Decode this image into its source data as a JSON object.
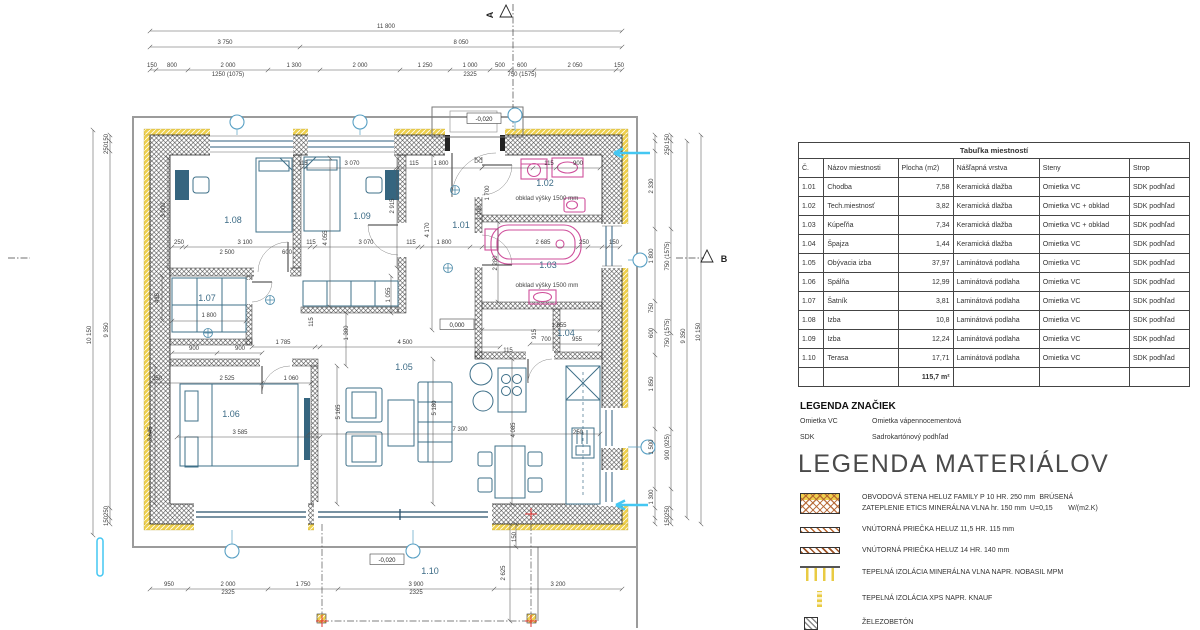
{
  "room_table": {
    "title": "Tabuľka miestností",
    "headers": [
      "Č.",
      "Názov miestnosti",
      "Plocha (m2)",
      "Nášľapná vrstva",
      "Steny",
      "Strop"
    ],
    "rows": [
      [
        "1.01",
        "Chodba",
        "7,58",
        "Keramická dlažba",
        "Omietka VC",
        "SDK podhľad"
      ],
      [
        "1.02",
        "Tech.miestnosť",
        "3,82",
        "Keramická dlažba",
        "Omietka VC + obklad",
        "SDK podhľad"
      ],
      [
        "1.03",
        "Kúpeľňa",
        "7,34",
        "Keramická dlažba",
        "Omietka VC + obklad",
        "SDK podhľad"
      ],
      [
        "1.04",
        "Špajza",
        "1,44",
        "Keramická dlažba",
        "Omietka VC",
        "SDK podhľad"
      ],
      [
        "1.05",
        "Obývacia izba",
        "37,97",
        "Laminátová podlaha",
        "Omietka VC",
        "SDK podhľad"
      ],
      [
        "1.06",
        "Spálňa",
        "12,99",
        "Laminátová podlaha",
        "Omietka VC",
        "SDK podhľad"
      ],
      [
        "1.07",
        "Šatník",
        "3,81",
        "Laminátová podlaha",
        "Omietka VC",
        "SDK podhľad"
      ],
      [
        "1.08",
        "Izba",
        "10,8",
        "Laminátová podlaha",
        "Omietka VC",
        "SDK podhľad"
      ],
      [
        "1.09",
        "Izba",
        "12,24",
        "Laminátová podlaha",
        "Omietka VC",
        "SDK podhľad"
      ],
      [
        "1.10",
        "Terasa",
        "17,71",
        "Laminátová podlaha",
        "Omietka VC",
        "SDK podhľad"
      ]
    ],
    "total": "115,7 m²"
  },
  "legend_symbols": {
    "title": "LEGENDA ZNAČIEK",
    "items": [
      {
        "abbr": "Omietka VC",
        "desc": "Omietka vápennocementová"
      },
      {
        "abbr": "SDK",
        "desc": "Sadrokartónový podhľad"
      }
    ]
  },
  "legend_materials": {
    "title": "LEGENDA MATERIÁLOV",
    "items": [
      {
        "icon": "extwall",
        "text": "OBVODOVÁ STENA HELUZ FAMILY P 10 HR. 250 mm  BRÚSENÁ\nZATEPLENIE ETICS MINERÁLNA VLNA hr. 150 mm  U=0,15        W/(m2.K)"
      },
      {
        "icon": "p115",
        "text": "VNÚTORNÁ PRIEČKA HELUZ 11,5 HR. 115 mm"
      },
      {
        "icon": "p140",
        "text": "VNÚTORNÁ PRIEČKA HELUZ 14 HR. 140 mm"
      },
      {
        "icon": "wool",
        "text": "TEPELNÁ IZOLÁCIA MINERÁLNA VLNA NAPR. NOBASIL MPM"
      },
      {
        "icon": "xps",
        "text": "TEPELNÁ IZOLÁCIA XPS NAPR. KNAUF"
      },
      {
        "icon": "zb",
        "text": "ŽELEZOBETÓN"
      }
    ]
  },
  "plan": {
    "rooms": [
      {
        "t": "1.01",
        "x": 461,
        "y": 228
      },
      {
        "t": "1.02",
        "x": 545,
        "y": 186
      },
      {
        "t": "1.03",
        "x": 548,
        "y": 268
      },
      {
        "t": "1.04",
        "x": 566,
        "y": 336
      },
      {
        "t": "1.05",
        "x": 404,
        "y": 370
      },
      {
        "t": "1.06",
        "x": 231,
        "y": 417
      },
      {
        "t": "1.07",
        "x": 207,
        "y": 301
      },
      {
        "t": "1.08",
        "x": 233,
        "y": 223
      },
      {
        "t": "1.09",
        "x": 362,
        "y": 219
      },
      {
        "t": "1.10",
        "x": 430,
        "y": 574
      }
    ],
    "notes": [
      {
        "t": "obklad výšky 1500 mm",
        "x": 547,
        "y": 200
      },
      {
        "t": "obklad výšky 1500 mm",
        "x": 547,
        "y": 287
      }
    ],
    "levels": [
      {
        "t": "-0,020",
        "x": 484,
        "y": 121
      },
      {
        "t": "0,000",
        "x": 457,
        "y": 327
      },
      {
        "t": "-0,020",
        "x": 387,
        "y": 562
      }
    ],
    "sections": [
      {
        "t": "A",
        "x": 493,
        "y": 15,
        "r": -90
      },
      {
        "t": "B",
        "x": 724,
        "y": 262
      }
    ],
    "dims": [
      {
        "t": "11 800",
        "x": 386,
        "y": 28
      },
      {
        "t": "3 750",
        "x": 225,
        "y": 44
      },
      {
        "t": "8 050",
        "x": 461,
        "y": 44
      },
      {
        "t": "150",
        "x": 152,
        "y": 67
      },
      {
        "t": "800",
        "x": 172,
        "y": 67
      },
      {
        "t": "2 000",
        "x": 228,
        "y": 67
      },
      {
        "t": "1 300",
        "x": 294,
        "y": 67
      },
      {
        "t": "2 000",
        "x": 360,
        "y": 67
      },
      {
        "t": "1 250",
        "x": 425,
        "y": 67
      },
      {
        "t": "1 000",
        "x": 470,
        "y": 67
      },
      {
        "t": "500",
        "x": 500,
        "y": 67
      },
      {
        "t": "600",
        "x": 522,
        "y": 67
      },
      {
        "t": "2 050",
        "x": 575,
        "y": 67
      },
      {
        "t": "150",
        "x": 619,
        "y": 67
      },
      {
        "t": "1250 (1075)",
        "x": 228,
        "y": 76
      },
      {
        "t": "2325",
        "x": 470,
        "y": 76
      },
      {
        "t": "750 (1575)",
        "x": 522,
        "y": 76
      },
      {
        "t": "950",
        "x": 169,
        "y": 586
      },
      {
        "t": "2 000",
        "x": 228,
        "y": 586
      },
      {
        "t": "2325",
        "x": 228,
        "y": 594
      },
      {
        "t": "1 750",
        "x": 303,
        "y": 586
      },
      {
        "t": "3 900",
        "x": 416,
        "y": 586
      },
      {
        "t": "2325",
        "x": 416,
        "y": 594
      },
      {
        "t": "3 200",
        "x": 558,
        "y": 586
      },
      {
        "t": "2 625",
        "x": 505,
        "y": 573,
        "r": -90
      },
      {
        "t": "150",
        "x": 516,
        "y": 537,
        "r": -90
      },
      {
        "t": "150",
        "x": 108,
        "y": 139,
        "r": -90
      },
      {
        "t": "250",
        "x": 108,
        "y": 149,
        "r": -90
      },
      {
        "t": "9 350",
        "x": 108,
        "y": 330,
        "r": -90
      },
      {
        "t": "250",
        "x": 108,
        "y": 511,
        "r": -90
      },
      {
        "t": "150",
        "x": 108,
        "y": 521,
        "r": -90
      },
      {
        "t": "10 150",
        "x": 91,
        "y": 335,
        "r": -90
      },
      {
        "t": "2 330",
        "x": 653,
        "y": 186,
        "r": -90
      },
      {
        "t": "1 800",
        "x": 653,
        "y": 256,
        "r": -90
      },
      {
        "t": "750",
        "x": 653,
        "y": 308,
        "r": -90
      },
      {
        "t": "600",
        "x": 653,
        "y": 333,
        "r": -90
      },
      {
        "t": "1 850",
        "x": 653,
        "y": 384,
        "r": -90
      },
      {
        "t": "1 500",
        "x": 653,
        "y": 447,
        "r": -90
      },
      {
        "t": "1 300",
        "x": 653,
        "y": 497,
        "r": -90
      },
      {
        "t": "150",
        "x": 669,
        "y": 139,
        "r": -90
      },
      {
        "t": "250",
        "x": 669,
        "y": 150,
        "r": -90
      },
      {
        "t": "750 (1575)",
        "x": 669,
        "y": 256,
        "r": -90
      },
      {
        "t": "750 (1575)",
        "x": 669,
        "y": 333,
        "r": -90
      },
      {
        "t": "900 (925)",
        "x": 669,
        "y": 447,
        "r": -90
      },
      {
        "t": "250",
        "x": 669,
        "y": 511,
        "r": -90
      },
      {
        "t": "150",
        "x": 669,
        "y": 521,
        "r": -90
      },
      {
        "t": "9 350",
        "x": 685,
        "y": 336,
        "r": -90
      },
      {
        "t": "10 150",
        "x": 700,
        "y": 332,
        "r": -90
      },
      {
        "t": "3 000",
        "x": 165,
        "y": 210,
        "r": -90
      },
      {
        "t": "250",
        "x": 179,
        "y": 244
      },
      {
        "t": "3 100",
        "x": 245,
        "y": 244
      },
      {
        "t": "2 500",
        "x": 227,
        "y": 254
      },
      {
        "t": "600",
        "x": 287,
        "y": 254
      },
      {
        "t": "115",
        "x": 311,
        "y": 244
      },
      {
        "t": "3 070",
        "x": 366,
        "y": 244
      },
      {
        "t": "115",
        "x": 303,
        "y": 165
      },
      {
        "t": "3 070",
        "x": 352,
        "y": 165
      },
      {
        "t": "4 055",
        "x": 327,
        "y": 238,
        "r": -90
      },
      {
        "t": "2 915",
        "x": 394,
        "y": 206,
        "r": -90
      },
      {
        "t": "4 170",
        "x": 429,
        "y": 230,
        "r": -90
      },
      {
        "t": "115",
        "x": 411,
        "y": 244
      },
      {
        "t": "1 800",
        "x": 444,
        "y": 244
      },
      {
        "t": "115",
        "x": 414,
        "y": 165
      },
      {
        "t": "1 800",
        "x": 441,
        "y": 165
      },
      {
        "t": "115",
        "x": 549,
        "y": 165
      },
      {
        "t": "900",
        "x": 578,
        "y": 165
      },
      {
        "t": "1 700",
        "x": 489,
        "y": 193,
        "r": -90
      },
      {
        "t": "1 100",
        "x": 481,
        "y": 213,
        "r": -90
      },
      {
        "t": "2 685",
        "x": 543,
        "y": 244
      },
      {
        "t": "250",
        "x": 584,
        "y": 244
      },
      {
        "t": "150",
        "x": 614,
        "y": 244
      },
      {
        "t": "2 280",
        "x": 497,
        "y": 263,
        "r": -90
      },
      {
        "t": "1 655",
        "x": 559,
        "y": 327
      },
      {
        "t": "700",
        "x": 546,
        "y": 341
      },
      {
        "t": "955",
        "x": 577,
        "y": 341
      },
      {
        "t": "915",
        "x": 536,
        "y": 334,
        "r": -90
      },
      {
        "t": "1 785",
        "x": 283,
        "y": 344
      },
      {
        "t": "4 500",
        "x": 405,
        "y": 344
      },
      {
        "t": "1 380",
        "x": 348,
        "y": 333,
        "r": -90
      },
      {
        "t": "1 055",
        "x": 390,
        "y": 295,
        "r": -90
      },
      {
        "t": "2 525",
        "x": 227,
        "y": 380
      },
      {
        "t": "1 060",
        "x": 291,
        "y": 380
      },
      {
        "t": "250",
        "x": 157,
        "y": 380
      },
      {
        "t": "3 585",
        "x": 240,
        "y": 434
      },
      {
        "t": "3 645",
        "x": 152,
        "y": 434,
        "r": -90
      },
      {
        "t": "5 165",
        "x": 340,
        "y": 412,
        "r": -90
      },
      {
        "t": "5 180",
        "x": 436,
        "y": 408,
        "r": -90
      },
      {
        "t": "7 300",
        "x": 460,
        "y": 431
      },
      {
        "t": "4 085",
        "x": 515,
        "y": 430,
        "r": -90
      },
      {
        "t": "250",
        "x": 578,
        "y": 434
      },
      {
        "t": "115",
        "x": 508,
        "y": 352
      },
      {
        "t": "900",
        "x": 194,
        "y": 350
      },
      {
        "t": "900",
        "x": 240,
        "y": 350
      },
      {
        "t": "1 800",
        "x": 209,
        "y": 317
      },
      {
        "t": "435",
        "x": 159,
        "y": 298,
        "r": -90
      },
      {
        "t": "115",
        "x": 313,
        "y": 322,
        "r": -90
      }
    ]
  }
}
